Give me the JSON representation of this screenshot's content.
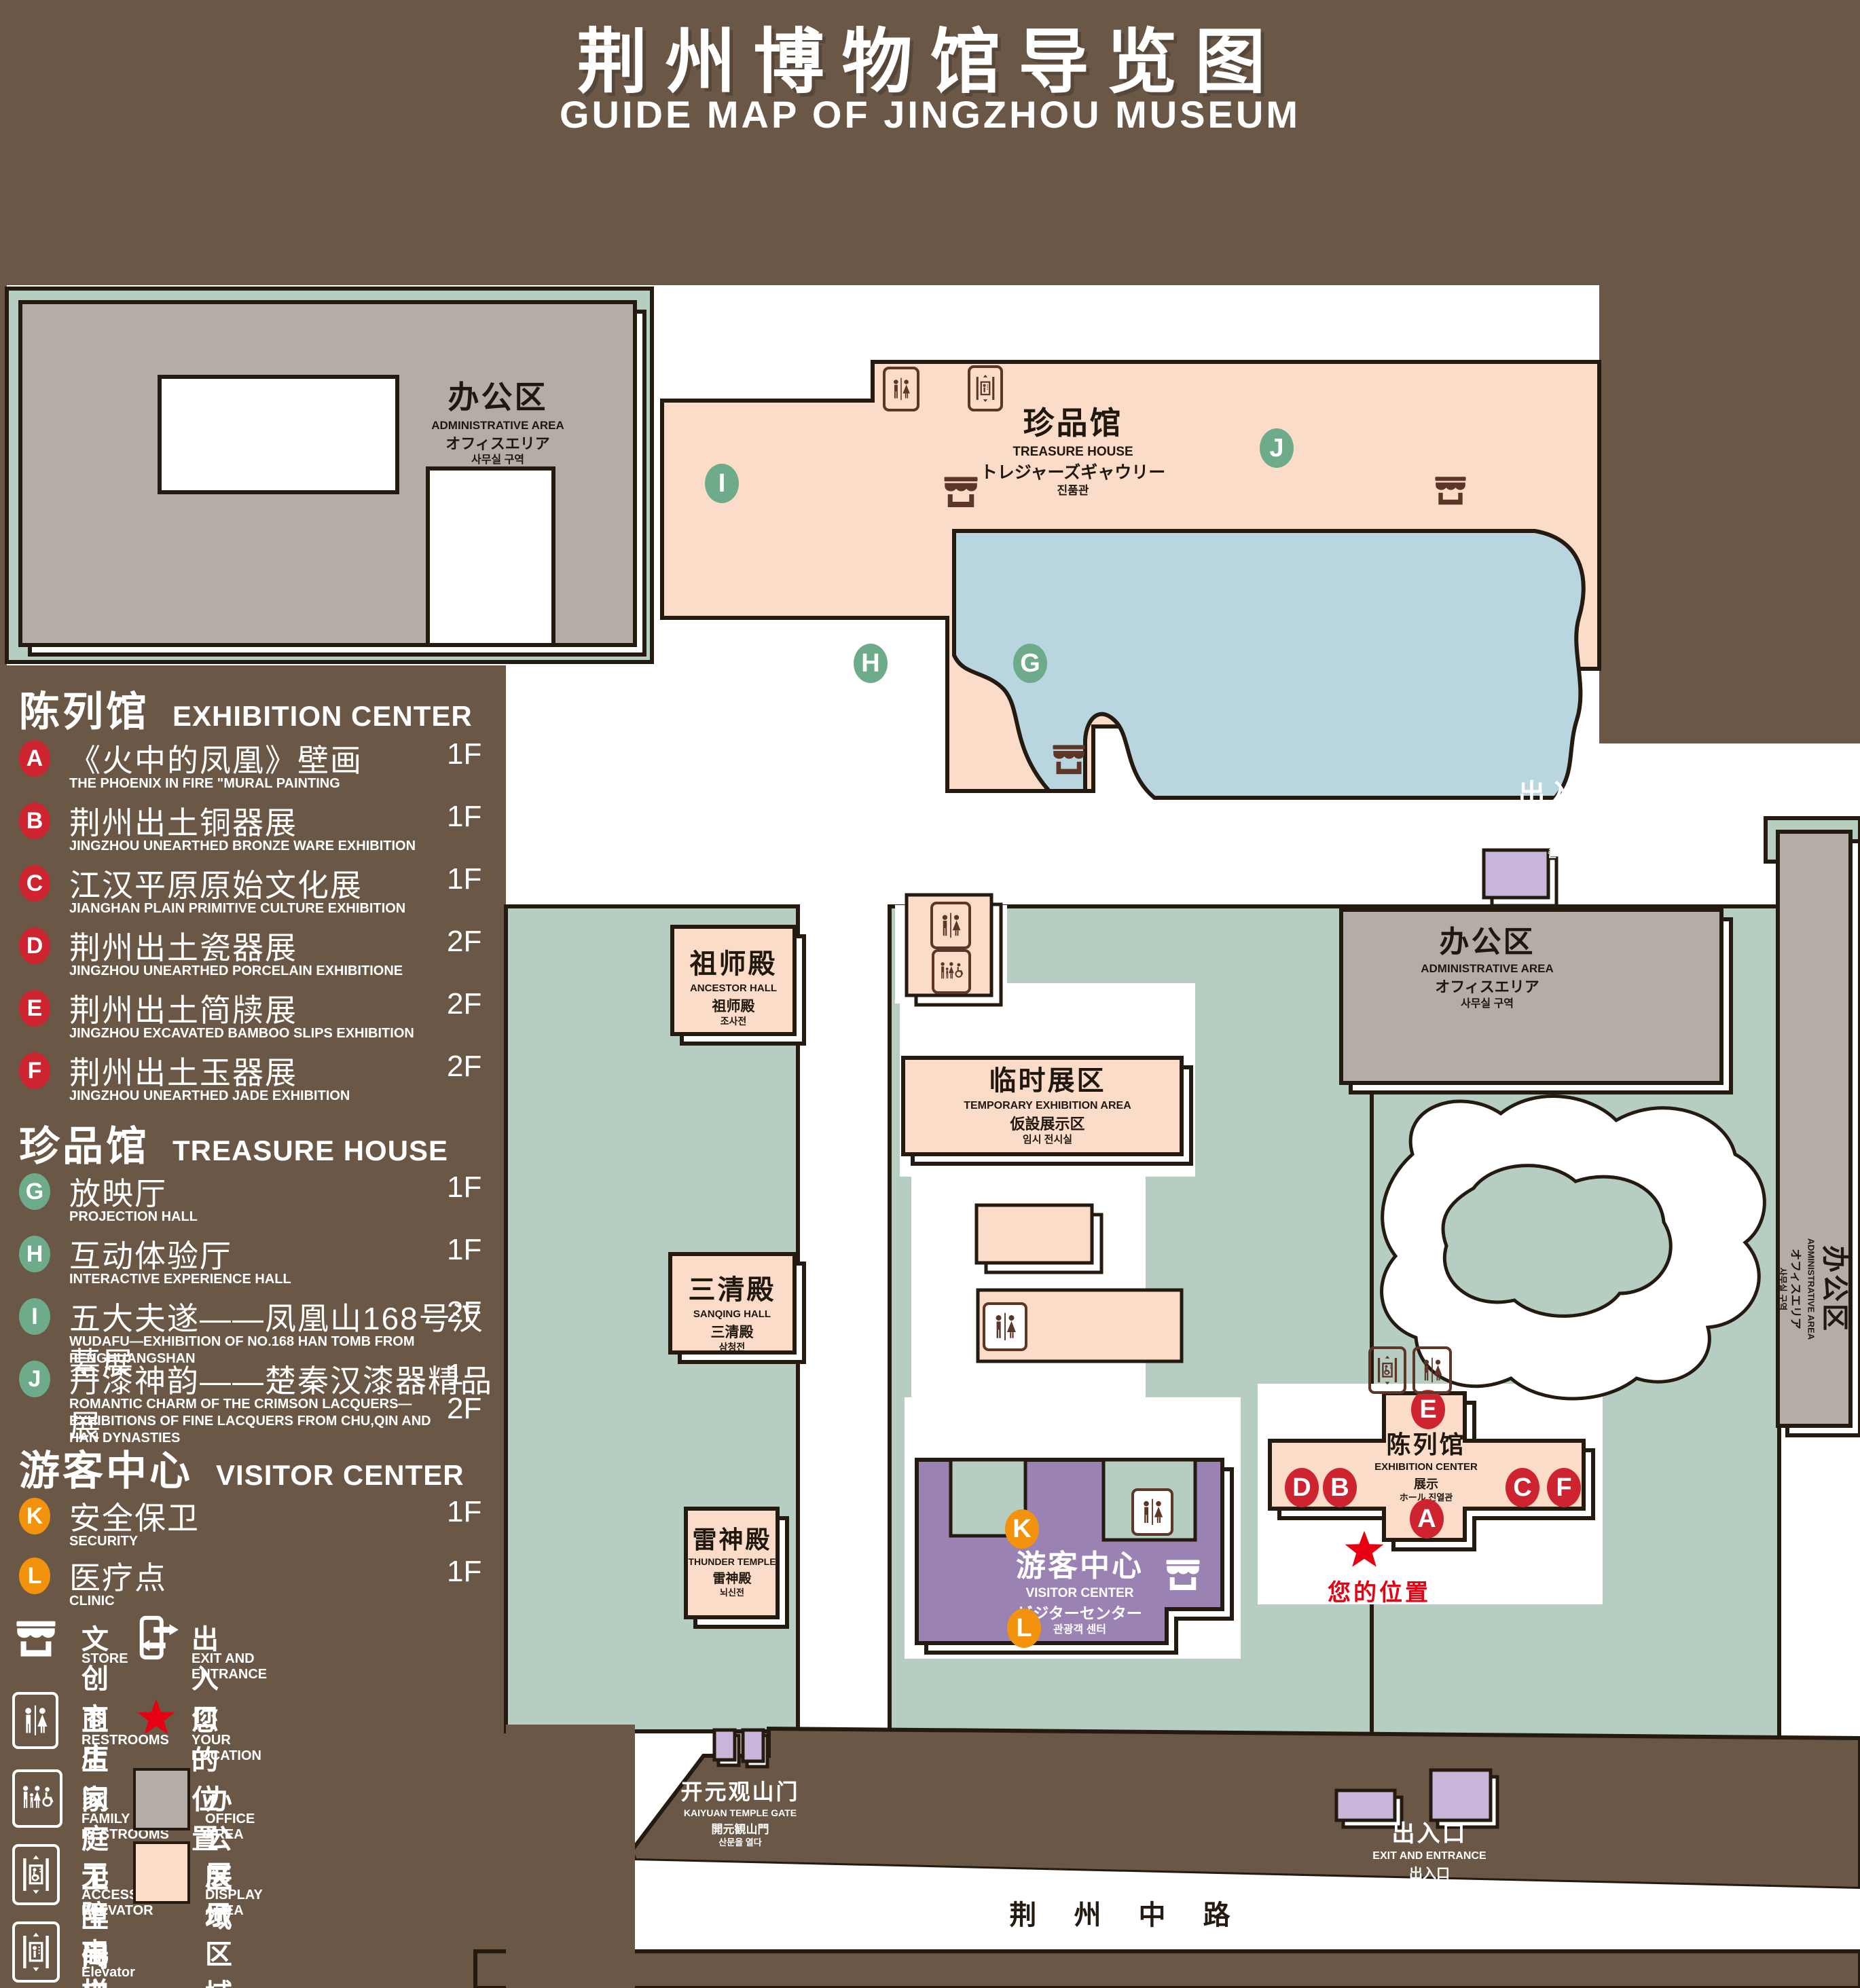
{
  "title": {
    "zh": "荆州博物馆导览图",
    "en": "GUIDE MAP OF JINGZHOU MUSEUM"
  },
  "colors": {
    "background": "#6a5746",
    "lawn": "#b6cec1",
    "display_area": "#fadcc8",
    "office_area": "#b3aca7",
    "visitor_center": "#9a83b3",
    "entrance_block": "#c8b5da",
    "pond": "#b9d5df",
    "outline": "#241a10",
    "marker_red": "#ce2430",
    "marker_green": "#6dab8a",
    "marker_orange": "#f2920d",
    "location_red": "#e60012",
    "icon_brown": "#5d3628"
  },
  "sidebar": {
    "sections": [
      {
        "zh": "陈列馆",
        "en": "EXHIBITION CENTER",
        "items": [
          {
            "letter": "A",
            "zh": "《火中的凤凰》壁画",
            "en": "THE PHOENIX IN FIRE \"MURAL PAINTING",
            "floor": "1F"
          },
          {
            "letter": "B",
            "zh": "荆州出土铜器展",
            "en": "JINGZHOU UNEARTHED BRONZE WARE EXHIBITION",
            "floor": "1F"
          },
          {
            "letter": "C",
            "zh": "江汉平原原始文化展",
            "en": "JIANGHAN PLAIN PRIMITIVE CULTURE EXHIBITION",
            "floor": "1F"
          },
          {
            "letter": "D",
            "zh": "荆州出土瓷器展",
            "en": "JINGZHOU UNEARTHED PORCELAIN EXHIBITIONE",
            "floor": "2F"
          },
          {
            "letter": "E",
            "zh": "荆州出土简牍展",
            "en": "JINGZHOU EXCAVATED BAMBOO SLIPS EXHIBITION",
            "floor": "2F"
          },
          {
            "letter": "F",
            "zh": "荆州出土玉器展",
            "en": "JINGZHOU UNEARTHED JADE EXHIBITION",
            "floor": "2F"
          }
        ]
      },
      {
        "zh": "珍品馆",
        "en": "TREASURE HOUSE",
        "items": [
          {
            "letter": "G",
            "zh": "放映厅",
            "en": "PROJECTION HALL",
            "floor": "1F"
          },
          {
            "letter": "H",
            "zh": "互动体验厅",
            "en": "INTERACTIVE EXPERIENCE HALL",
            "floor": "1F"
          },
          {
            "letter": "I",
            "zh": "五大夫遂——凤凰山168号汉墓展",
            "en": "WUDAFU—EXHIBITION OF NO.168 HAN TOMB FROM FENGHUANGSHAN",
            "floor": "2F"
          },
          {
            "letter": "J",
            "zh": "丹漆神韵——楚秦汉漆器精品展",
            "en": "ROMANTIC CHARM OF THE CRIMSON LACQUERS—EXHIBITIONS OF FINE LACQUERS FROM CHU,QIN AND HAN DYNASTIES",
            "floor": "1-2F"
          }
        ]
      },
      {
        "zh": "游客中心",
        "en": "VISITOR CENTER",
        "items": [
          {
            "letter": "K",
            "zh": "安全保卫",
            "en": "SECURITY",
            "floor": "1F"
          },
          {
            "letter": "L",
            "zh": "医疗点",
            "en": "CLINIC",
            "floor": "1F"
          }
        ]
      }
    ],
    "legend": [
      {
        "icon": "store-icon",
        "zh": "文创商店",
        "en": "STORE"
      },
      {
        "icon": "exit-icon",
        "zh": "出入口",
        "en": "EXIT AND ENTRANCE"
      },
      {
        "icon": "restroom-icon",
        "zh": "卫生间",
        "en": "RESTROOMS"
      },
      {
        "icon": "location-star-icon",
        "zh": "您的位置",
        "en": "YOUR LOCATION"
      },
      {
        "icon": "family-restroom-icon",
        "zh": "家庭卫生间",
        "en": "FAMILY RESTROOMS"
      },
      {
        "icon": "office-area-swatch",
        "zh": "办公区域",
        "en": "OFFICE AREA"
      },
      {
        "icon": "accessible-elevator-icon",
        "zh": "无障碍电梯",
        "en": "ACCESSIBLE ELEVATOR"
      },
      {
        "icon": "display-area-swatch",
        "zh": "展示区域",
        "en": "DISPLAY AREA"
      },
      {
        "icon": "elevator-icon",
        "zh": "电梯",
        "en": "Elevator"
      }
    ]
  },
  "map": {
    "admin_area_nw": {
      "zh": "办公区",
      "en": "ADMINISTRATIVE AREA",
      "l3": "オフィスエリア",
      "l4": "사무실 구역"
    },
    "treasure_house": {
      "zh": "珍品馆",
      "en": "TREASURE HOUSE",
      "l3": "トレジャーズギャウリー",
      "l4": "진품관"
    },
    "exit_east": {
      "zh": "出入口",
      "en": "EXIT AND ENTRANCE",
      "l3": "出入口",
      "l4": "출입구"
    },
    "admin_area_east": {
      "zh": "办公区",
      "en": "ADMINISTRATIVE AREA",
      "l3": "オフィスエリア",
      "l4": "사무실 구역"
    },
    "admin_area_far_east": {
      "zh": "办公区",
      "en": "ADMINISTRATIVE AREA",
      "l3": "オフィスエリア",
      "l4": "사무실 구역"
    },
    "ancestor_hall": {
      "zh": "祖师殿",
      "en": "ANCESTOR HALL",
      "l3": "祖师殿",
      "l4": "조사전"
    },
    "temporary_exhibition": {
      "zh": "临时展区",
      "en": "TEMPORARY EXHIBITION AREA",
      "l3": "仮設展示区",
      "l4": "임시 전시실"
    },
    "sanqing_hall": {
      "zh": "三清殿",
      "en": "SANQING HALL",
      "l3": "三清殿",
      "l4": "삼청전"
    },
    "thunder_temple": {
      "zh": "雷神殿",
      "en": "THUNDER TEMPLE",
      "l3": "雷神殿",
      "l4": "뇌신전"
    },
    "visitor_center": {
      "zh": "游客中心",
      "en": "VISITOR CENTER",
      "l3": "ビジターセンター",
      "l4": "관광객 센터"
    },
    "exhibition_center": {
      "zh": "陈列馆",
      "en": "EXHIBITION CENTER",
      "l3": "展示",
      "l4": "ホール 진열관"
    },
    "kaiyuan_gate": {
      "zh": "开元观山门",
      "en": "KAIYUAN TEMPLE GATE",
      "l3": "開元観山門",
      "l4": "산문을 열다"
    },
    "exit_south": {
      "zh": "出入口",
      "en": "EXIT AND ENTRANCE",
      "l3": "出入口",
      "l4": "출입구"
    },
    "road": "荆 州 中 路",
    "your_location": "您的位置",
    "markers": [
      {
        "letter": "I",
        "color": "green"
      },
      {
        "letter": "J",
        "color": "green"
      },
      {
        "letter": "H",
        "color": "green"
      },
      {
        "letter": "G",
        "color": "green"
      },
      {
        "letter": "E",
        "color": "red"
      },
      {
        "letter": "D",
        "color": "red"
      },
      {
        "letter": "B",
        "color": "red"
      },
      {
        "letter": "C",
        "color": "red"
      },
      {
        "letter": "F",
        "color": "red"
      },
      {
        "letter": "A",
        "color": "red"
      },
      {
        "letter": "K",
        "color": "orange"
      },
      {
        "letter": "L",
        "color": "orange"
      }
    ]
  }
}
